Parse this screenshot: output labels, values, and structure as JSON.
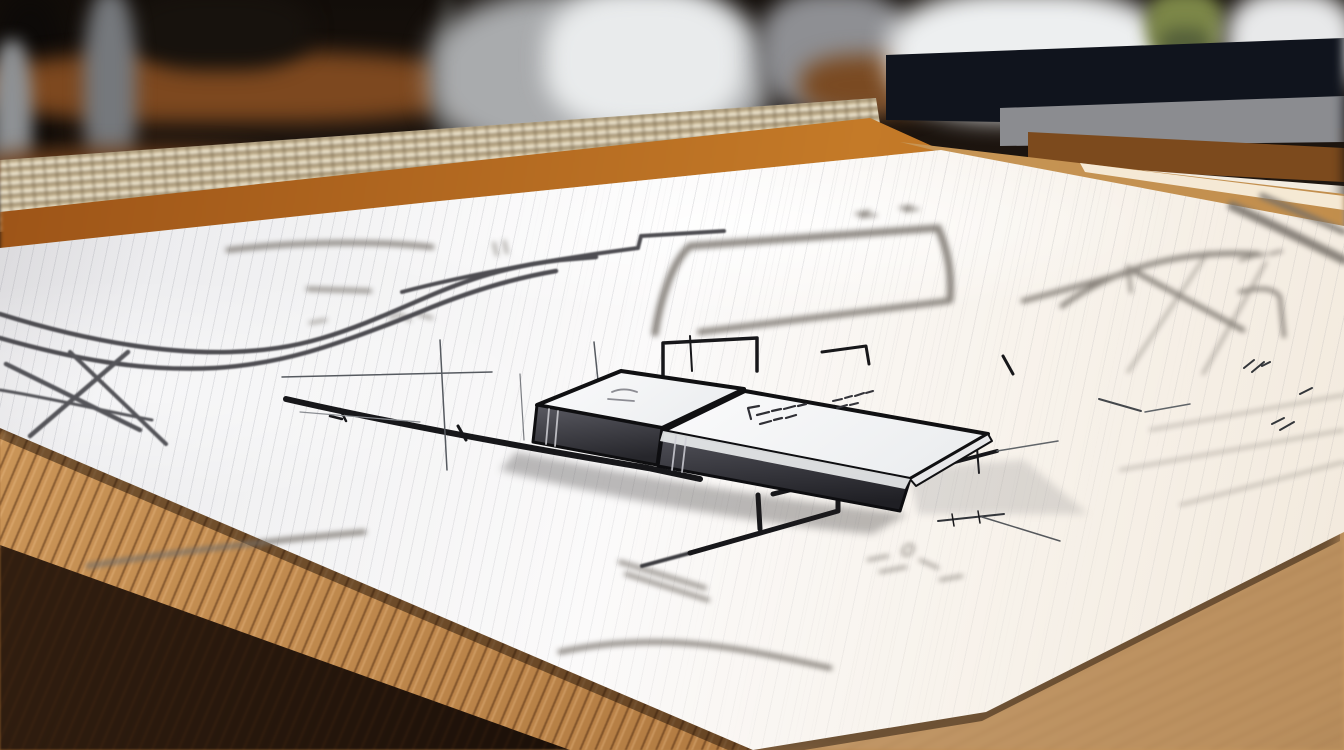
{
  "meta": {
    "domain": "Natural-Image",
    "description": "Close-up photograph of a hand-sketched architectural floor plan on a white sheet lying on a wooden drafting table. Two flat gray eraser-like slabs with scribbled tops rest on the drawing. The background is an out-of-focus workshop: warm wood shelving, gray posts, bright window highlights, a dark navy cabinet band and a hint of green foliage. A beige woven cane strip and orange wood rails run behind the top edge of the paper.",
    "image_width_px": 1344,
    "image_height_px": 750
  },
  "visible_text": [],
  "scene": {
    "background": {
      "items": [
        {
          "name": "workshop-shelf-blur",
          "description": "dark blurred shelving with warm wood bands and gray posts",
          "color": "#7d481f"
        },
        {
          "name": "bright-window-blur",
          "description": "soft white-gray out-of-focus highlights, center and right",
          "color": "#e9ebec"
        },
        {
          "name": "olive-foliage-blur",
          "description": "small green-olive blurred plant at top right",
          "color": "#7c8748"
        },
        {
          "name": "navy-cabinet-band",
          "description": "dark navy horizontal band behind the table",
          "color": "#10141d"
        },
        {
          "name": "woven-cane-strip",
          "description": "beige woven strip with checkered texture, sloping up to the right",
          "color": "#cdbd9c"
        },
        {
          "name": "wood-rails",
          "description": "orange-brown wood rails between the strip and the paper",
          "color": "#c47a28"
        }
      ]
    },
    "table": {
      "surface_color_light": "#c79a62",
      "edge_color": "#b97e42",
      "shadow_color": "#17100a",
      "bottom_right_color": "#c79d6d",
      "grain": "diagonal streaked wood grain; lower-left edge in sharp focus, bottom-right softly blurred"
    },
    "paper": {
      "color": "#f7f6f4",
      "warm_tint": "#f2e9dc",
      "ruling": "faint parallel guide lines sloping up to the right",
      "shape": "large sheet in perspective; bottom-right corner rounded on the wood; top edge rises toward upper right"
    },
    "drawing": {
      "style": "hand-sketched floor plan; mix of sharp ink lines and blurred gray marker strokes",
      "ink_color": "#17171a",
      "marker_gray": "#756f68",
      "features": [
        "double S-curve marker stroke sweeping in from the left edge",
        "large blurred rectangular wall loop at top center",
        "blurred tilted rectangle room outline on the right",
        "heavy diagonal wall line left of the slabs with tick marks",
        "stepped sharp wall lines above and right of the slabs",
        "heavy stepped line running down-left below the slabs",
        "clusters of tiny illegible dimension scribbles",
        "crossed gray strokes at the lower-left paper edge",
        "thick gray sweeps entering from the top-right corner"
      ]
    },
    "objects": [
      {
        "name": "eraser-slab-left",
        "description": "thin rectangular slab; white top face outlined in black ink; dark gray front face with light seams near its left end",
        "top_color": "#f6f6f7",
        "side_color": "#3f3f46",
        "outline_color": "#101012"
      },
      {
        "name": "eraser-slab-right",
        "description": "longer thin slab overlapping in front; white top face with illegible scribbled marks; dark gray front face with a thin white bevel edge",
        "top_color": "#f8f8f9",
        "side_color": "#46464e",
        "outline_color": "#101012",
        "top_marks": "two clusters of illegible handwritten scribbles"
      },
      {
        "name": "checkered-scale-strip",
        "description": "small white strip with black hatch marks poking out from under the sheet at lower left",
        "color": "#f1ecdc",
        "mark_color": "#1e1e1e"
      }
    ]
  },
  "palette": {
    "background_dark": "#241a14",
    "shelf_wood": "#7d481f",
    "navy_band": "#10141d",
    "woven_beige": "#cdbd9c",
    "rail_orange": "#c47a28",
    "table_tan": "#c79d6d",
    "table_edge": "#b97e42",
    "table_shadow": "#17100a",
    "paper_white": "#f7f6f4",
    "ink_black": "#17171a",
    "marker_gray": "#756f68",
    "slab_side_gray": "#46464e",
    "olive_green": "#7c8748"
  }
}
